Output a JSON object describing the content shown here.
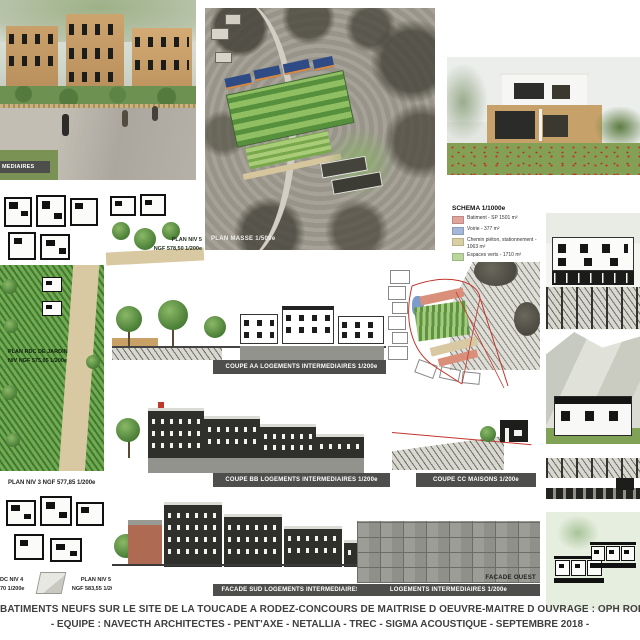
{
  "captions": {
    "render_left": "MEDIAIRES",
    "plan_masse": "PLAN MASSE 1/500e"
  },
  "legend": {
    "title": "SCHEMA 1/1000e",
    "items": [
      {
        "color": "#dfa49a",
        "label": "Batiment - SP 1501 m²"
      },
      {
        "color": "#a3b8d8",
        "label": "Voirie - 377 m²"
      },
      {
        "color": "#d8d0a2",
        "label": "Chemin piéton, stationnement - 1063 m²"
      },
      {
        "color": "#b9d69c",
        "label": "Espaces verts - 1710 m²"
      }
    ]
  },
  "plan_labels": {
    "niv5_top_l1": "PLAN NIV 5",
    "niv5_top_l2": "NGF 578,50 1/200e",
    "rdc_jardin_l1": "PLAN RDC DE JARDIN",
    "rdc_jardin_l2": "NIV NGF 575,05 1/200e",
    "niv3": "PLAN NIV 3 NGF 577,85 1/200e",
    "rdc_niv4_l1": "DC NIV 4",
    "rdc_niv4_l2": "70 1/200e",
    "niv5_bottom_l1": "PLAN NIV 5",
    "niv5_bottom_l2": "NGF 583,55 1/200e"
  },
  "section_labels": {
    "coupe_aa": "COUPE AA LOGEMENTS INTERMEDIAIRES 1/200e",
    "coupe_bb": "COUPE BB LOGEMENTS INTERMEDIAIRES 1/200e",
    "coupe_cc": "COUPE CC MAISONS 1/200e",
    "facade_sud": "FACADE SUD LOGEMENTS INTERMEDIAIRES 1/200e",
    "facade_ouest_title": "FACADE OUEST",
    "facade_ouest": "LOGEMENTS INTERMEDIAIRES 1/200e"
  },
  "footer": {
    "line1": "BATIMENTS NEUFS SUR LE SITE DE LA TOUCADE A RODEZ-CONCOURS DE MAITRISE D OEUVRE-MAITRE D OUVRAGE : OPH RODEZ A",
    "line2": "- EQUIPE : NAVECTH ARCHITECTES - PENT'AXE - NETALLIA - TREC - SIGMA ACOUSTIQUE - SEPTEMBRE 2018 -"
  },
  "colors": {
    "label_bar": "#4e4e4c",
    "red_line": "#c2362c",
    "wood": "#c6a26a",
    "plan_green": "#5d9440"
  }
}
